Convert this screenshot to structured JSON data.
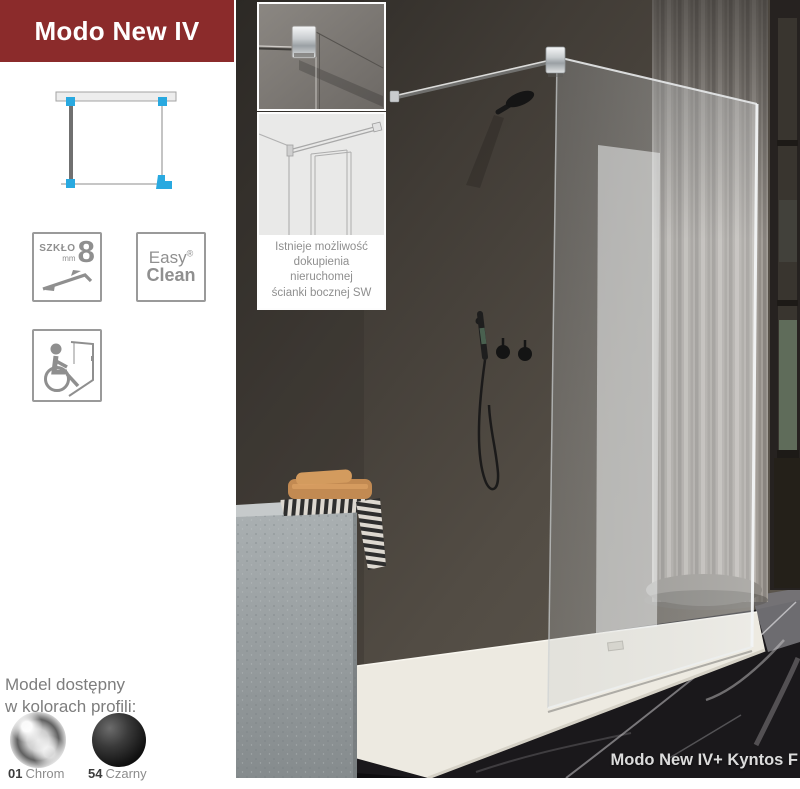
{
  "colors": {
    "brand_red": "#8b2b2b",
    "accent_blue": "#29a9e0",
    "icon_gray": "#8f8f8f",
    "text_gray": "#7d7d7d",
    "label_dark": "#3c3c3c"
  },
  "header": {
    "title": "Modo New IV"
  },
  "inset_note": {
    "line1": "Istnieje możliwość",
    "line2": "dokupienia",
    "line3": "nieruchomej",
    "line4": "ścianki bocznej SW"
  },
  "badges": {
    "glass": {
      "label": "SZKŁO",
      "unit": "mm",
      "value": "8"
    },
    "easy_clean": {
      "word1": "Easy",
      "word2": "Clean",
      "registered": "®"
    }
  },
  "availability": {
    "heading_line1": "Model dostępny",
    "heading_line2": "w kolorach profili:",
    "options": [
      {
        "code": "01",
        "name": "Chrom"
      },
      {
        "code": "54",
        "name": "Czarny"
      }
    ]
  },
  "photo": {
    "caption": "Modo New IV+ Kyntos F"
  }
}
